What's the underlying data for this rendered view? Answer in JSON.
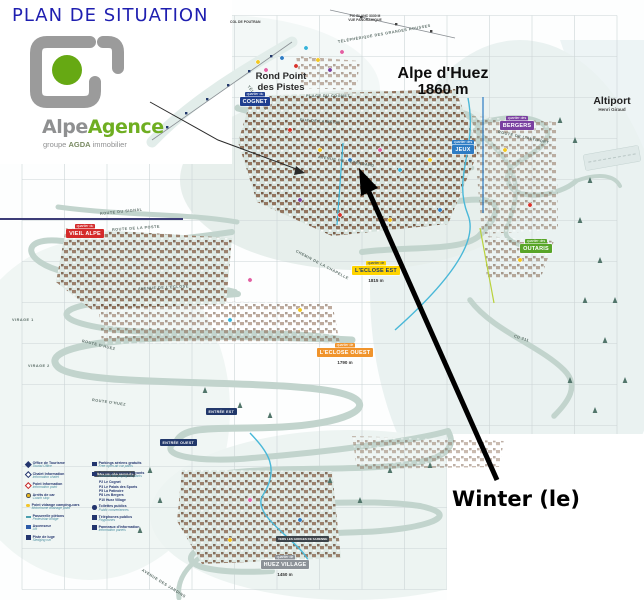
{
  "title": "PLAN DE SITUATION",
  "logo": {
    "brand_gray": "Alpe",
    "brand_green": "Agence",
    "tagline_pre": "groupe",
    "tagline_bold": "AGDA",
    "tagline_post": "immobilier"
  },
  "property": {
    "name": "Winter (le)"
  },
  "resort": {
    "name": "Alpe d'Huez",
    "altitude": "1860 m"
  },
  "landmarks": {
    "rond_point_line1": "Rond Point",
    "rond_point_line2": "des Pistes",
    "altiport": "Altiport",
    "altiport_sub": "Henri Giraud",
    "pic_blanc_line1": "PIC BLANC 3330 M",
    "pic_blanc_line2": "VUE PANORAMIQUE",
    "col_de_poutran": "COL DE POUTRAN"
  },
  "quartiers": {
    "cognet": {
      "tab": "quartier du",
      "label": "COGNET"
    },
    "vieil_alpe": {
      "tab": "quartier du",
      "label": "VIEIL ALPE"
    },
    "jeux": {
      "tab": "quartier des",
      "label": "JEUX"
    },
    "bergers": {
      "tab": "quartier des",
      "label": "BERGERS"
    },
    "outaris": {
      "tab": "quartier des",
      "label": "OUTARIS"
    },
    "eclose_est": {
      "tab": "quartier de",
      "label": "L'ECLOSE EST",
      "altitude": "1815 m"
    },
    "eclose_ouest": {
      "tab": "quartier de",
      "label": "L'ECLOSE OUEST",
      "altitude": "1790 m"
    },
    "huez_village": {
      "tab": "quartier de",
      "label": "HUEZ VILLAGE",
      "altitude": "1450 m"
    }
  },
  "entrances": {
    "est": "ENTRÉE EST",
    "ouest": "ENTRÉE OUEST"
  },
  "signs": {
    "villard": "VERS VILLARD RECULAS",
    "gorges": "VERS LES GORGES DE SARENNE"
  },
  "streets": [
    {
      "t": "ROUTE DU SIGNAL",
      "x": 100,
      "y": 212,
      "r": -6
    },
    {
      "t": "ROUTE DE LA POSTE",
      "x": 112,
      "y": 228,
      "r": -4
    },
    {
      "t": "AVENUE DE L'ECLOSE",
      "x": 138,
      "y": 287,
      "r": -3
    },
    {
      "t": "ROUTE D'HUEZ",
      "x": 82,
      "y": 339,
      "r": 14
    },
    {
      "t": "ROUTE D'HUEZ",
      "x": 92,
      "y": 398,
      "r": 8
    },
    {
      "t": "VIRAGE 1",
      "x": 12,
      "y": 318,
      "r": 0
    },
    {
      "t": "VIRAGE 2",
      "x": 28,
      "y": 364,
      "r": 0
    },
    {
      "t": "AVENUE DE L'ETENDARD",
      "x": 318,
      "y": 155,
      "r": 9
    },
    {
      "t": "RUE DE LA MEIJE",
      "x": 300,
      "y": 118,
      "r": 4
    },
    {
      "t": "PLACE DU COGNET",
      "x": 306,
      "y": 94,
      "r": 0
    },
    {
      "t": "CHEMIN DE LA CHAPELLE",
      "x": 296,
      "y": 249,
      "r": 28
    },
    {
      "t": "AVENUE DES JARDINS",
      "x": 142,
      "y": 568,
      "r": 32
    },
    {
      "t": "ROUTE DE L'ALTIPORT",
      "x": 498,
      "y": 130,
      "r": 12
    },
    {
      "t": "TÉLÉCENTRE",
      "x": 248,
      "y": 84,
      "r": 52
    },
    {
      "t": "TÉLÉPHÉRIQUE DES GRANDES ROUSSES",
      "x": 338,
      "y": 40,
      "r": -10
    },
    {
      "t": "CD 211",
      "x": 514,
      "y": 334,
      "r": 18
    }
  ],
  "grid": {
    "labels": [
      {
        "t": "F",
        "x": 250,
        "y": 0
      },
      {
        "t": "G",
        "x": 293,
        "y": 0
      },
      {
        "t": "H",
        "x": 334,
        "y": 0
      },
      {
        "t": "I",
        "x": 374,
        "y": 0
      },
      {
        "t": "J",
        "x": 418,
        "y": 0
      },
      {
        "t": "A",
        "x": 39,
        "y": 166
      },
      {
        "t": "B",
        "x": 83,
        "y": 166
      },
      {
        "t": "C",
        "x": 126,
        "y": 166
      },
      {
        "t": "D",
        "x": 168,
        "y": 166
      },
      {
        "t": "J",
        "x": 419,
        "y": 427
      },
      {
        "t": "K",
        "x": 461,
        "y": 427
      },
      {
        "t": "L",
        "x": 505,
        "y": 427
      },
      {
        "t": "M",
        "x": 547,
        "y": 427
      },
      {
        "t": "N",
        "x": 588,
        "y": 427
      },
      {
        "t": "A",
        "x": 39,
        "y": 588
      },
      {
        "t": "B",
        "x": 80,
        "y": 588
      },
      {
        "t": "C",
        "x": 124,
        "y": 588
      },
      {
        "t": "D",
        "x": 166,
        "y": 588
      },
      {
        "t": "E",
        "x": 208,
        "y": 588
      },
      {
        "t": "F",
        "x": 249,
        "y": 588
      },
      {
        "t": "G",
        "x": 292,
        "y": 588
      },
      {
        "t": "5",
        "x": 5,
        "y": 196
      },
      {
        "t": "6",
        "x": 5,
        "y": 236
      },
      {
        "t": "7",
        "x": 5,
        "y": 281
      },
      {
        "t": "8",
        "x": 5,
        "y": 319
      },
      {
        "t": "9",
        "x": 5,
        "y": 360
      },
      {
        "t": "10",
        "x": 3,
        "y": 402
      },
      {
        "t": "11",
        "x": 3,
        "y": 443
      },
      {
        "t": "12",
        "x": 3,
        "y": 484
      },
      {
        "t": "13",
        "x": 3,
        "y": 525
      },
      {
        "t": "14",
        "x": 3,
        "y": 564
      },
      {
        "t": "1",
        "x": 184,
        "y": 34
      },
      {
        "t": "2",
        "x": 184,
        "y": 72
      },
      {
        "t": "3",
        "x": 184,
        "y": 111
      },
      {
        "t": "2",
        "x": 625,
        "y": 71
      },
      {
        "t": "4",
        "x": 625,
        "y": 154
      },
      {
        "t": "6",
        "x": 625,
        "y": 236
      },
      {
        "t": "7",
        "x": 625,
        "y": 276
      },
      {
        "t": "8",
        "x": 625,
        "y": 319
      },
      {
        "t": "11",
        "x": 327,
        "y": 441
      },
      {
        "t": "12",
        "x": 327,
        "y": 482
      },
      {
        "t": "13",
        "x": 327,
        "y": 523
      },
      {
        "t": "14",
        "x": 327,
        "y": 563
      }
    ]
  },
  "legend": {
    "left": [
      {
        "fr": "Office de Tourisme",
        "en": "Tourist Office"
      },
      {
        "fr": "Chalet Information",
        "en": "Information chalet"
      },
      {
        "fr": "Point Information",
        "en": "Information point"
      },
      {
        "fr": "Arrêts de car",
        "en": "Coach stop"
      },
      {
        "fr": "Point vidange camping-cars",
        "en": "Motorhome drainage point"
      },
      {
        "fr": "Passerelle piétons",
        "en": "Pedestrian bridge"
      },
      {
        "fr": "Ascenseur",
        "en": "Lift"
      },
      {
        "fr": "Piste de luge",
        "en": "Sledging run"
      }
    ],
    "right": [
      {
        "fr": "Parkings aériens gratuits",
        "en": "Free open-air car parks"
      },
      {
        "fr": "Parkings couverts payants",
        "en": "Covered fee-paying car parks"
      },
      {
        "fr": "Toilettes publics",
        "en": "Public conveniences"
      },
      {
        "fr": "Téléphones publics",
        "en": "Payphones"
      },
      {
        "fr": "Panneaux d'information",
        "en": "Information panels"
      }
    ],
    "parkings": [
      "P2 Le Cognet",
      "P3 Le Palais des Sports",
      "P5 La Patinoire",
      "P8 Les Bergers",
      "P10 Huez Village"
    ]
  },
  "theme": {
    "title_blue": "#1f1fb0",
    "logo_green": "#6fae21",
    "logo_gray": "#9b9b9b",
    "badge_navy": "#1e3e8f",
    "badge_red": "#d42a2a",
    "badge_blue": "#2d7cc4",
    "badge_purple": "#7a3fa0",
    "badge_green": "#58a528",
    "badge_yellow": "#ffd400",
    "badge_orange": "#f0942c",
    "badge_gray": "#8d9298",
    "arrow_black": "#000000",
    "road_teal": "#c2d4cd",
    "stream_cyan": "#49b8d8",
    "lift_blue": "#2d7cc4"
  }
}
